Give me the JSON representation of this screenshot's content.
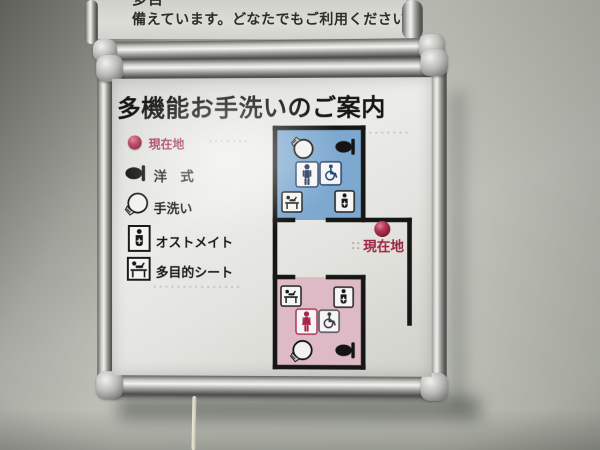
{
  "upper_sign": {
    "line1_partial": "多目",
    "line2": "備えています。どなたでもご利用ください。"
  },
  "sign": {
    "title": "多機能お手洗いのご案内",
    "legend": [
      {
        "icon": "current-location-dot-icon",
        "label": "現在地"
      },
      {
        "icon": "western-toilet-icon",
        "label": "洋　式"
      },
      {
        "icon": "hand-wash-basin-icon",
        "label": "手洗い"
      },
      {
        "icon": "ostomate-icon",
        "label": "オストメイト"
      },
      {
        "icon": "multipurpose-sheet-icon",
        "label": "多目的シート"
      }
    ],
    "map": {
      "current_location_label": "現在地",
      "marker_color": "#9e1f3d",
      "label_color": "#9c2440",
      "wall_color": "#161616",
      "rooms": [
        {
          "id": "room-blue",
          "fill": "#7da8cf",
          "icons": [
            "hand-wash-basin-icon",
            "western-toilet-icon",
            "male-icon",
            "wheelchair-icon",
            "multipurpose-sheet-icon",
            "ostomate-icon"
          ]
        },
        {
          "id": "room-pink",
          "fill": "#ddbac6",
          "icons": [
            "multipurpose-sheet-icon",
            "ostomate-icon",
            "female-icon",
            "wheelchair-icon",
            "hand-wash-basin-icon",
            "western-toilet-icon"
          ]
        }
      ]
    },
    "colors": {
      "legend_location_text": "#9d2b4b"
    }
  }
}
